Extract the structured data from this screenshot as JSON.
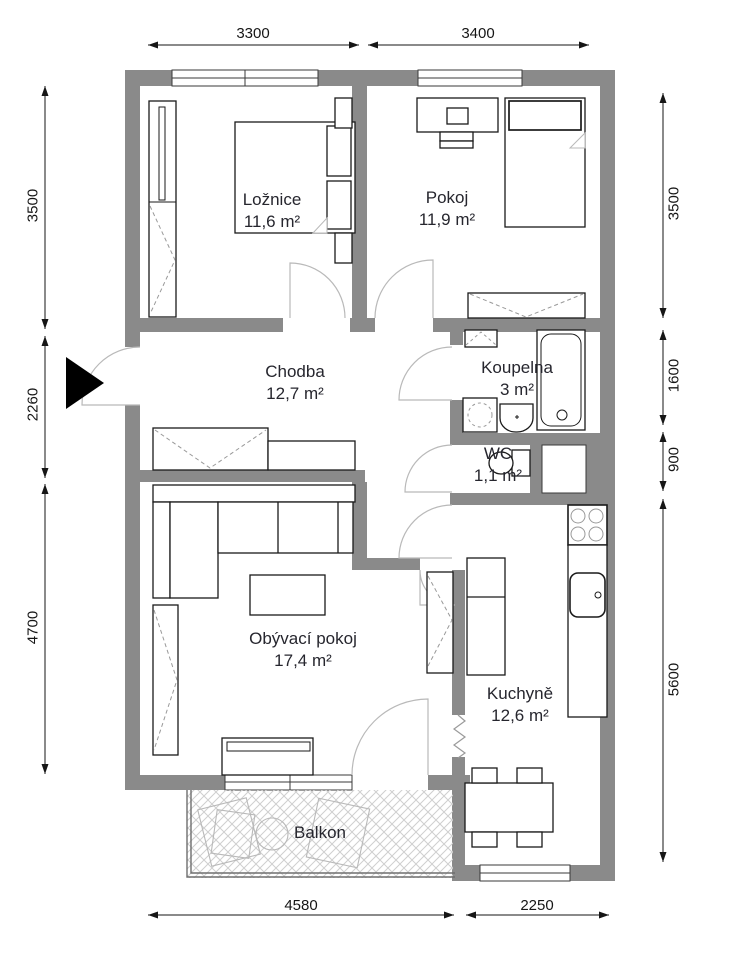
{
  "rooms": {
    "loznice": {
      "name": "Ložnice",
      "area": "11,6 m²"
    },
    "pokoj": {
      "name": "Pokoj",
      "area": "11,9 m²"
    },
    "chodba": {
      "name": "Chodba",
      "area": "12,7 m²"
    },
    "koupelna": {
      "name": "Koupelna",
      "area": "3 m²"
    },
    "wc": {
      "name": "WC",
      "area": "1,1 m²"
    },
    "obyvaci_pokoj": {
      "name": "Obývací pokoj",
      "area": "17,4 m²"
    },
    "kuchyne": {
      "name": "Kuchyně",
      "area": "12,6 m²"
    },
    "balkon": {
      "name": "Balkon"
    }
  },
  "dimensions": {
    "top": {
      "left": "3300",
      "right": "3400"
    },
    "left": {
      "top": "3500",
      "middle": "2260",
      "bottom": "4700"
    },
    "right": {
      "top": "3500",
      "upper_middle": "1600",
      "lower_middle": "900",
      "bottom": "5600"
    },
    "bottom": {
      "left": "4580",
      "right": "2250"
    }
  },
  "colors": {
    "wall": "#8a8a8a",
    "outline": "#1a1a1a",
    "sketch": "#b9b9b9",
    "text": "#26262e"
  }
}
